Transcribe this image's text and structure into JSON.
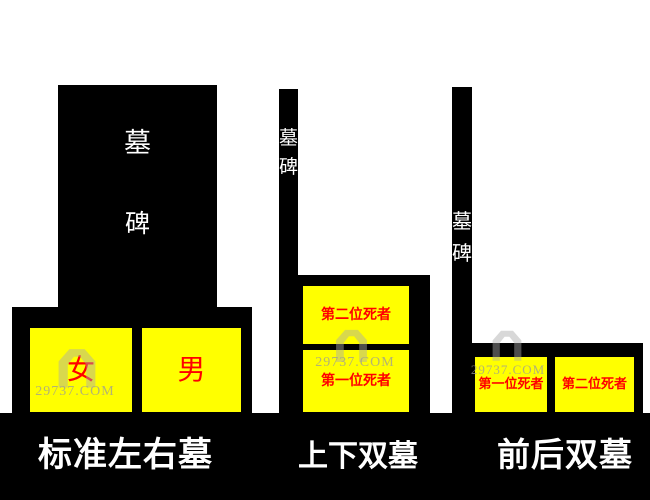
{
  "colors": {
    "background": "#FFFFFF",
    "stone_black": "#000000",
    "plot_yellow": "#FFFF00",
    "label_red": "#FF0000",
    "stone_text_white": "#FFFFFF",
    "caption_white": "#FFFFFF",
    "watermark_gray": "#9A9A9A"
  },
  "watermark": {
    "text": "29737.COM"
  },
  "diagrams": [
    {
      "caption": "标准左右墓",
      "stone_char_top": "墓",
      "stone_char_bottom": "碑",
      "plots": [
        {
          "label": "女"
        },
        {
          "label": "男"
        }
      ]
    },
    {
      "caption": "上下双墓",
      "stone_char_top": "墓",
      "stone_char_bottom": "碑",
      "plots": [
        {
          "label": "第二位死者"
        },
        {
          "label": "第一位死者"
        }
      ]
    },
    {
      "caption": "前后双墓",
      "stone_char_top": "墓",
      "stone_char_bottom": "碑",
      "plots": [
        {
          "label": "第一位死者"
        },
        {
          "label": "第二位死者"
        }
      ]
    }
  ]
}
